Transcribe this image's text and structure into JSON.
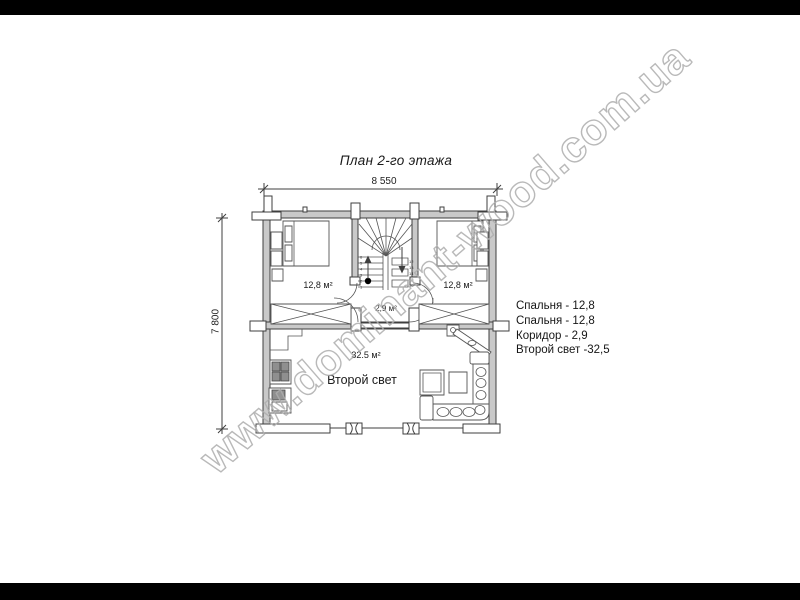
{
  "page": {
    "title": "План 2-го этажа"
  },
  "dimensions": {
    "top": "8 550",
    "left": "7 800"
  },
  "rooms": {
    "bedroom_left_area": "12,8 м²",
    "bedroom_right_area": "12,8 м²",
    "corridor_area": "2,9 м²",
    "second_light_area": "32.5 м²",
    "second_light_name": "Второй свет"
  },
  "legend": {
    "items": [
      "Спальня - 12,8",
      "Спальня - 12,8",
      "Коридор - 2,9",
      "Второй свет -32,5"
    ]
  },
  "stairs": {
    "numbers_left": [
      "1",
      "2",
      "3",
      "4",
      "5",
      "6"
    ],
    "numbers_right": [
      "12",
      "13",
      "14",
      "15",
      "16"
    ]
  },
  "watermark": "www.dominant-wood.com.ua",
  "colors": {
    "letterbox": "#000000",
    "line": "#3f3f3f",
    "wall_fill": "#c9c9c9",
    "watermark_outline": "#adadad",
    "background": "#ffffff"
  }
}
